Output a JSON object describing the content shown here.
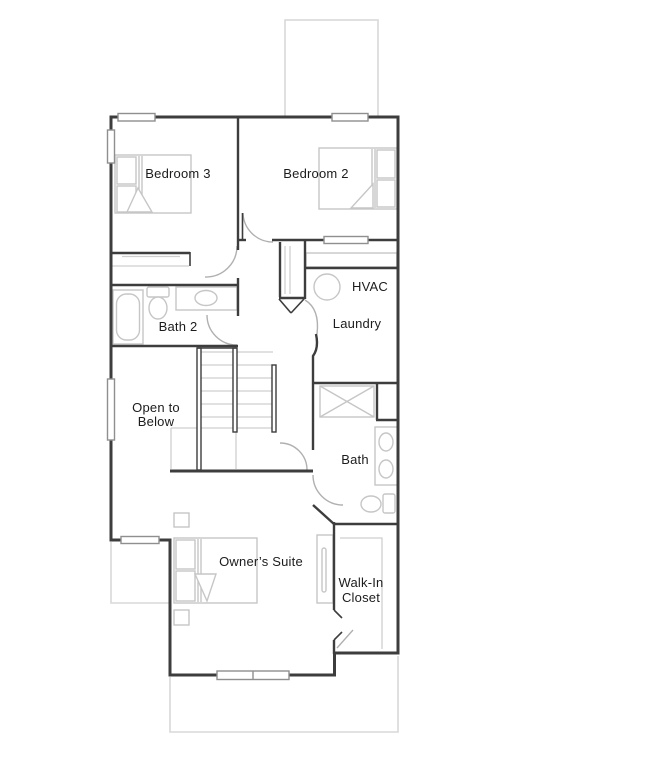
{
  "plan": {
    "type": "residential-floor-plan",
    "rooms": [
      {
        "id": "bedroom-3",
        "lines": [
          "Bedroom 3"
        ]
      },
      {
        "id": "bedroom-2",
        "lines": [
          "Bedroom 2"
        ]
      },
      {
        "id": "bath-2",
        "lines": [
          "Bath 2"
        ]
      },
      {
        "id": "hvac",
        "lines": [
          "HVAC"
        ]
      },
      {
        "id": "laundry",
        "lines": [
          "Laundry"
        ]
      },
      {
        "id": "open-to-below",
        "lines": [
          "Open to",
          "Below"
        ]
      },
      {
        "id": "bath",
        "lines": [
          "Bath"
        ]
      },
      {
        "id": "owners-suite",
        "lines": [
          "Owner’s Suite"
        ]
      },
      {
        "id": "walk-in-closet",
        "lines": [
          "Walk-In",
          "Closet"
        ]
      }
    ]
  },
  "colors": {
    "wall": "#3d3d3d",
    "fixture": "#c6c6c6",
    "roof-outline": "#d8d8d8",
    "door-swing": "#b0b0b0",
    "window-border": "#8f8f8f",
    "label-text": "#1c1c1e"
  }
}
